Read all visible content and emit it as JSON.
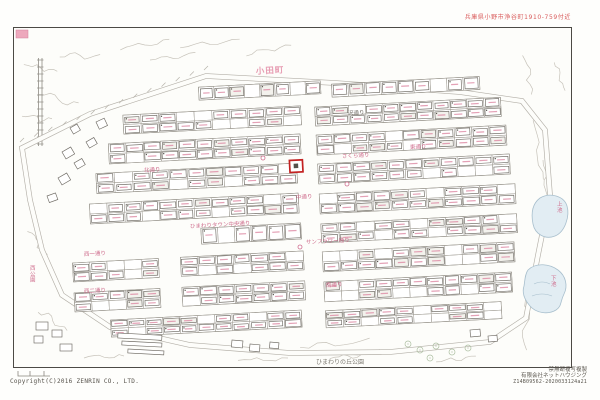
{
  "header": {
    "note": "兵庫県小野市浄谷町1910-759付近"
  },
  "footer": {
    "copyright": "Copyright(C)2016 ZENRIN CO., LTD.",
    "right_lines": [
      "禁無断複写複製",
      "有限会社ネットハウジング",
      "Z14B09562-2020033124a21"
    ]
  },
  "map": {
    "area_label": {
      "text": "小田町",
      "x": 256,
      "y": 74
    },
    "park_label": {
      "text": "ひまわりの丘公園",
      "x": 316,
      "y": 364
    },
    "street_labels": [
      {
        "text": "沢通り",
        "x": 348,
        "y": 115,
        "gray": true
      },
      {
        "text": "さくら通り",
        "x": 342,
        "y": 158
      },
      {
        "text": "中通り",
        "x": 296,
        "y": 199
      },
      {
        "text": "東通り",
        "x": 410,
        "y": 149
      },
      {
        "text": "北通り",
        "x": 144,
        "y": 172
      },
      {
        "text": "ひまわりタウン中央通り",
        "x": 190,
        "y": 228
      },
      {
        "text": "サンフラワー通り",
        "x": 306,
        "y": 244
      },
      {
        "text": "南通り",
        "x": 326,
        "y": 287
      },
      {
        "text": "西一通り",
        "x": 84,
        "y": 256
      },
      {
        "text": "西二通り",
        "x": 84,
        "y": 293
      }
    ],
    "vertical_labels": [
      {
        "text": "西公園",
        "x": 30,
        "y": 270
      },
      {
        "text": "上池",
        "x": 557,
        "y": 206
      },
      {
        "text": "下池",
        "x": 551,
        "y": 280
      }
    ],
    "colors": {
      "street_label": "#cf6e8e",
      "gray_label": "#77736c",
      "area_label": "#e79cb2",
      "park_label": "#7d7a72",
      "note_red": "#d95b5b",
      "highlight": "#c32222",
      "pond_fill": "#e2edf3",
      "pond_edge": "#a8bfcd"
    }
  }
}
